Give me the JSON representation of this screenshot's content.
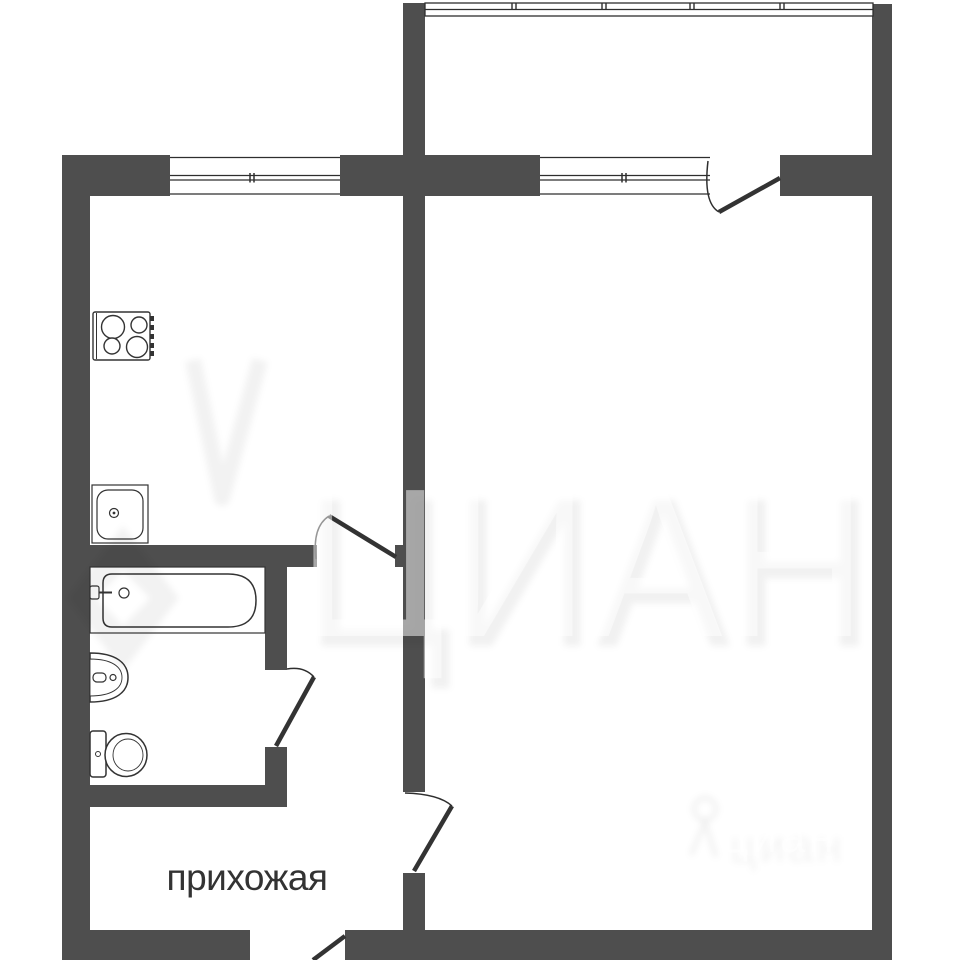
{
  "floorplan": {
    "room_labels": {
      "hallway": "прихожая"
    },
    "watermark": {
      "brand_large": "ЦИАН",
      "brand_small": "циан"
    },
    "colors": {
      "wall_fill": "#4e4e4e",
      "outline": "#333333",
      "background": "#ffffff",
      "label_text": "#333333"
    },
    "fixtures": [
      "stove",
      "kitchen-sink",
      "bathtub",
      "washbasin",
      "toilet"
    ],
    "windows": [
      "balcony-glazing",
      "kitchen-window",
      "living-room-window"
    ],
    "doors": [
      "balcony-door",
      "kitchen-door",
      "bathroom-door",
      "living-room-door",
      "entrance-door"
    ]
  }
}
